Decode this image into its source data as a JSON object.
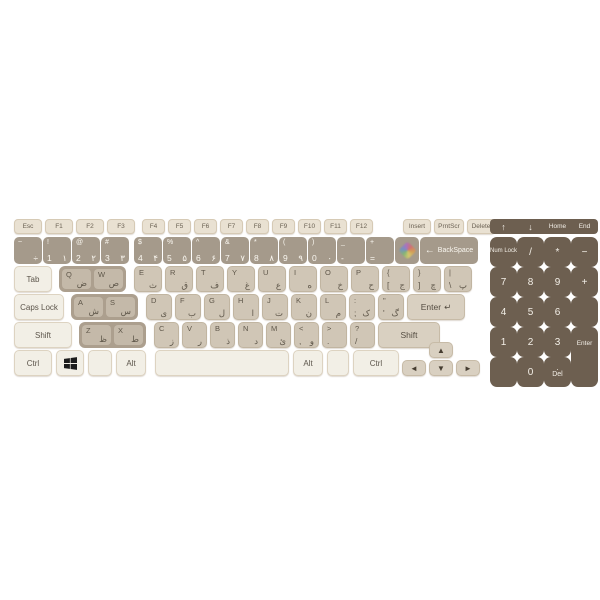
{
  "colors": {
    "background": "#ffffff",
    "function_key": "#e9e1d2",
    "number_band": "#a59a8b",
    "left_letter_panel": "#ac9f8e",
    "left_letter_key": "#c4b9a9",
    "right_letter_key": "#d0c6b6",
    "modifier_key": "#f2efe6",
    "accent_key": "#d9d0c1",
    "numpad": "#6d5f50",
    "numpad_text": "#f3efe7",
    "dark_text": "#5f574a",
    "light_text": "#faf7f0"
  },
  "function_row": {
    "left": [
      "Esc",
      "F1",
      "F2",
      "F3"
    ],
    "middle": [
      "F4",
      "F5",
      "F6",
      "F7",
      "F8",
      "F9",
      "F10",
      "F11",
      "F12"
    ],
    "right": [
      "Insert",
      "PrntScr",
      "Delete"
    ]
  },
  "number_row": {
    "left": [
      {
        "shift": "~",
        "latin": "",
        "farsi": "÷"
      },
      {
        "shift": "!",
        "latin": "1",
        "farsi": "۱"
      },
      {
        "shift": "@",
        "latin": "2",
        "farsi": "۲"
      },
      {
        "shift": "#",
        "latin": "3",
        "farsi": "۳"
      }
    ],
    "right": [
      {
        "shift": "$",
        "latin": "4",
        "farsi": "۴"
      },
      {
        "shift": "%",
        "latin": "5",
        "farsi": "۵"
      },
      {
        "shift": "^",
        "latin": "6",
        "farsi": "۶"
      },
      {
        "shift": "&",
        "latin": "7",
        "farsi": "۷"
      },
      {
        "shift": "*",
        "latin": "8",
        "farsi": "۸"
      },
      {
        "shift": "(",
        "latin": "9",
        "farsi": "۹"
      },
      {
        "shift": ")",
        "latin": "0",
        "farsi": "۰"
      },
      {
        "shift": "_",
        "latin": "-",
        "farsi": ""
      },
      {
        "shift": "+",
        "latin": "=",
        "farsi": ""
      }
    ],
    "language_icon": "color-diamond",
    "backspace_arrow": "←",
    "backspace_label": "BackSpace"
  },
  "letter_rows": {
    "tab": "Tab",
    "q_left": [
      {
        "latin": "Q",
        "farsi": "ض"
      },
      {
        "latin": "W",
        "farsi": "ص"
      }
    ],
    "q_right": [
      {
        "latin": "E",
        "farsi": "ث"
      },
      {
        "latin": "R",
        "farsi": "ق"
      },
      {
        "latin": "T",
        "farsi": "ف"
      },
      {
        "latin": "Y",
        "farsi": "غ"
      },
      {
        "latin": "U",
        "farsi": "ع"
      },
      {
        "latin": "I",
        "farsi": "ه"
      },
      {
        "latin": "O",
        "farsi": "خ"
      },
      {
        "latin": "P",
        "farsi": "ح"
      },
      {
        "shift": "{",
        "latin": "[",
        "farsi": "ج"
      },
      {
        "shift": "}",
        "latin": "]",
        "farsi": "چ"
      },
      {
        "shift": "|",
        "latin": "\\",
        "farsi": "پ"
      }
    ],
    "caps": "Caps Lock",
    "a_left": [
      {
        "latin": "A",
        "farsi": "ش"
      },
      {
        "latin": "S",
        "farsi": "س"
      }
    ],
    "a_right": [
      {
        "latin": "D",
        "farsi": "ی"
      },
      {
        "latin": "F",
        "farsi": "ب"
      },
      {
        "latin": "G",
        "farsi": "ل"
      },
      {
        "latin": "H",
        "farsi": "ا"
      },
      {
        "latin": "J",
        "farsi": "ت"
      },
      {
        "latin": "K",
        "farsi": "ن"
      },
      {
        "latin": "L",
        "farsi": "م"
      },
      {
        "shift": ":",
        "latin": ";",
        "farsi": "ک"
      },
      {
        "shift": "\"",
        "latin": "'",
        "farsi": "گ"
      }
    ],
    "enter_label": "Enter",
    "enter_arrow": "↵",
    "shift_left": "Shift",
    "z_left": [
      {
        "latin": "Z",
        "farsi": "ظ"
      },
      {
        "latin": "X",
        "farsi": "ط"
      }
    ],
    "z_right": [
      {
        "latin": "C",
        "farsi": "ز"
      },
      {
        "latin": "V",
        "farsi": "ر"
      },
      {
        "latin": "B",
        "farsi": "ذ"
      },
      {
        "latin": "N",
        "farsi": "د"
      },
      {
        "latin": "M",
        "farsi": "ئ"
      },
      {
        "shift": "<",
        "latin": ",",
        "farsi": "و"
      },
      {
        "shift": ">",
        "latin": ".",
        "farsi": ""
      },
      {
        "shift": "?",
        "latin": "/",
        "farsi": ""
      }
    ],
    "shift_right": "Shift"
  },
  "bottom_row": {
    "ctrl_left": "Ctrl",
    "windows_icon": "windows-logo",
    "alt_left": "Alt",
    "alt_right": "Alt",
    "ctrl_right": "Ctrl"
  },
  "arrow_keys": {
    "up": "▲",
    "left": "◄",
    "down": "▼",
    "right": "►"
  },
  "numpad": {
    "nav": [
      "↑",
      "↓",
      "Home",
      "End"
    ],
    "row1": [
      "Num Lock",
      "/",
      "*",
      "−"
    ],
    "row2": [
      "7",
      "8",
      "9",
      "+"
    ],
    "row3": [
      "4",
      "5",
      "6"
    ],
    "row4": [
      "1",
      "2",
      "3"
    ],
    "enter": "Enter",
    "zero": "0",
    "del_dot": ".",
    "del": "Del"
  }
}
